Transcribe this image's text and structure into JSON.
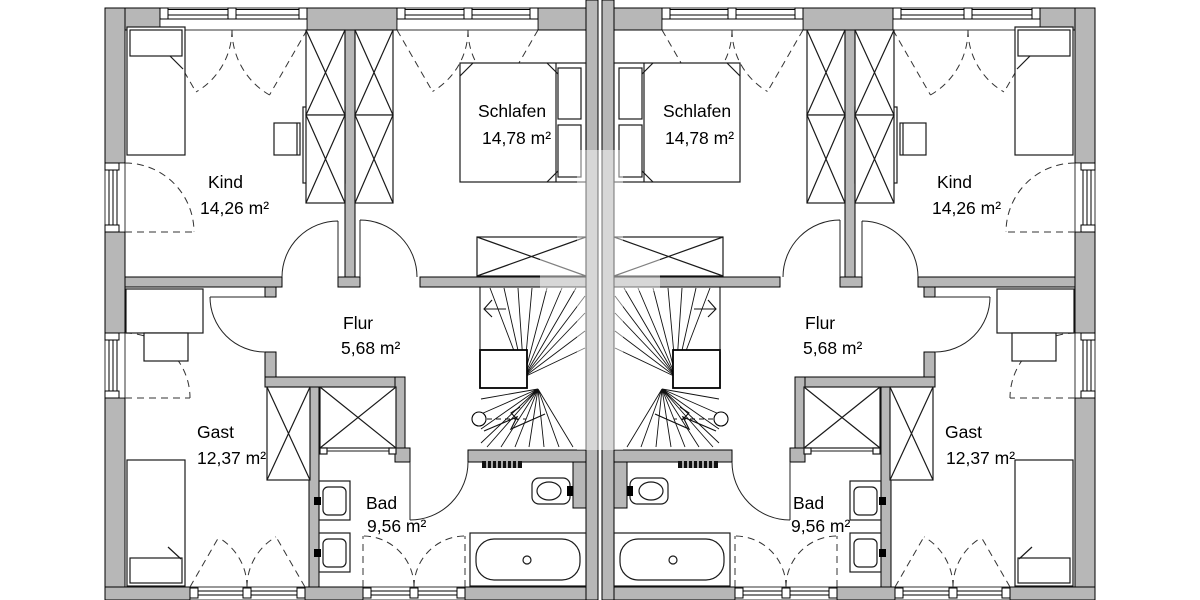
{
  "plan": {
    "kind": "floor-plan",
    "language": "de",
    "units": [
      {
        "id": "left",
        "rooms": [
          {
            "name": "Kind",
            "area": "14,26 m²"
          },
          {
            "name": "Schlafen",
            "area": "14,78 m²"
          },
          {
            "name": "Flur",
            "area": "5,68 m²"
          },
          {
            "name": "Gast",
            "area": "12,37 m²"
          },
          {
            "name": "Bad",
            "area": "9,56 m²"
          }
        ]
      },
      {
        "id": "right",
        "rooms": [
          {
            "name": "Kind",
            "area": "14,26 m²"
          },
          {
            "name": "Schlafen",
            "area": "14,78 m²"
          },
          {
            "name": "Flur",
            "area": "5,68 m²"
          },
          {
            "name": "Gast",
            "area": "12,37 m²"
          },
          {
            "name": "Bad",
            "area": "9,56 m²"
          }
        ]
      }
    ],
    "colors": {
      "wall": "#b7b7b7",
      "line": "#000000",
      "furniture_line": "#1a1a1a"
    }
  }
}
